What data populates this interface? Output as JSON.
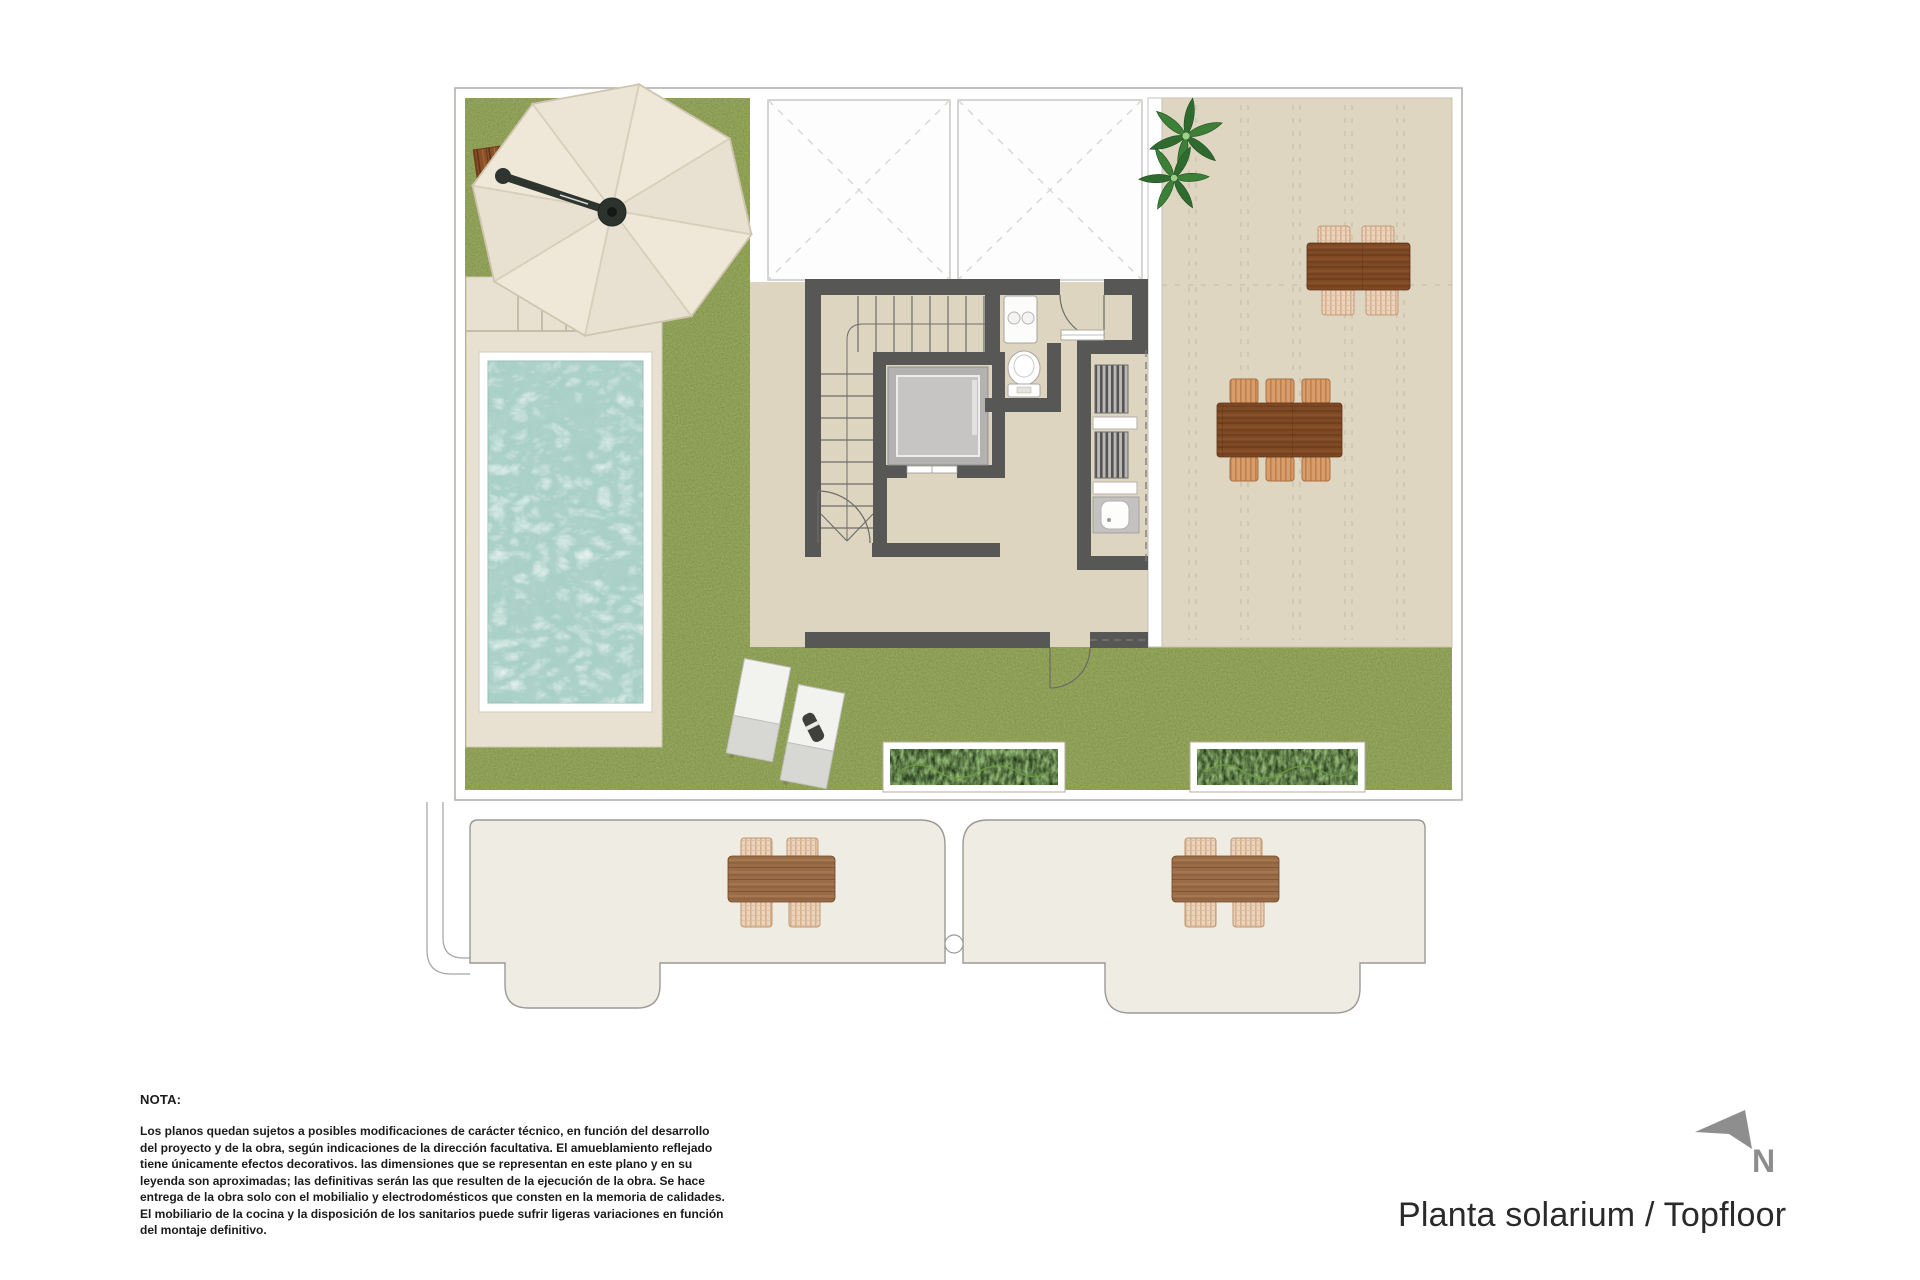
{
  "palette": {
    "grass": "#8a9b50",
    "water": "#a9d0c7",
    "deck": "#e8e1d1",
    "floor": "#ddd5bf",
    "terrace": "#ded6c1",
    "wall": "#575756",
    "canopy": "#ece4d5",
    "lower_floor": "#efece3",
    "planter": "#223a17",
    "wood_dark": "#7e4a26",
    "wood_light": "#9b6c48",
    "wicker": "#ecd3bd",
    "arrow_gray": "#8d8d8d",
    "title_text": "#2a2a2a",
    "note_text": "#1b1b1b",
    "outline": "#b0ada8"
  },
  "plan": {
    "title": "Planta solarium / Topfloor",
    "compass": {
      "label": "N",
      "icon": "north-arrow"
    }
  },
  "note": {
    "heading": "NOTA:",
    "lines": [
      "Los planos quedan sujetos a posibles modificaciones de carácter técnico, en función del desarrollo",
      "del proyecto y de la obra, según indicaciones de la dirección facultativa. El amueblamiento reflejado",
      "tiene únicamente efectos decorativos. las dimensiones que se representan en este plano y en su",
      "leyenda son aproximadas; las definitivas serán las que resulten de la ejecución de la obra. Se hace",
      "entrega de la obra solo con el mobilialio y electrodomésticos que consten en la memoria de calidades.",
      "El mobiliario de la cocina y la disposición de los sanitarios puede sufrir ligeras variaciones en función",
      "del montaje definitivo."
    ]
  }
}
